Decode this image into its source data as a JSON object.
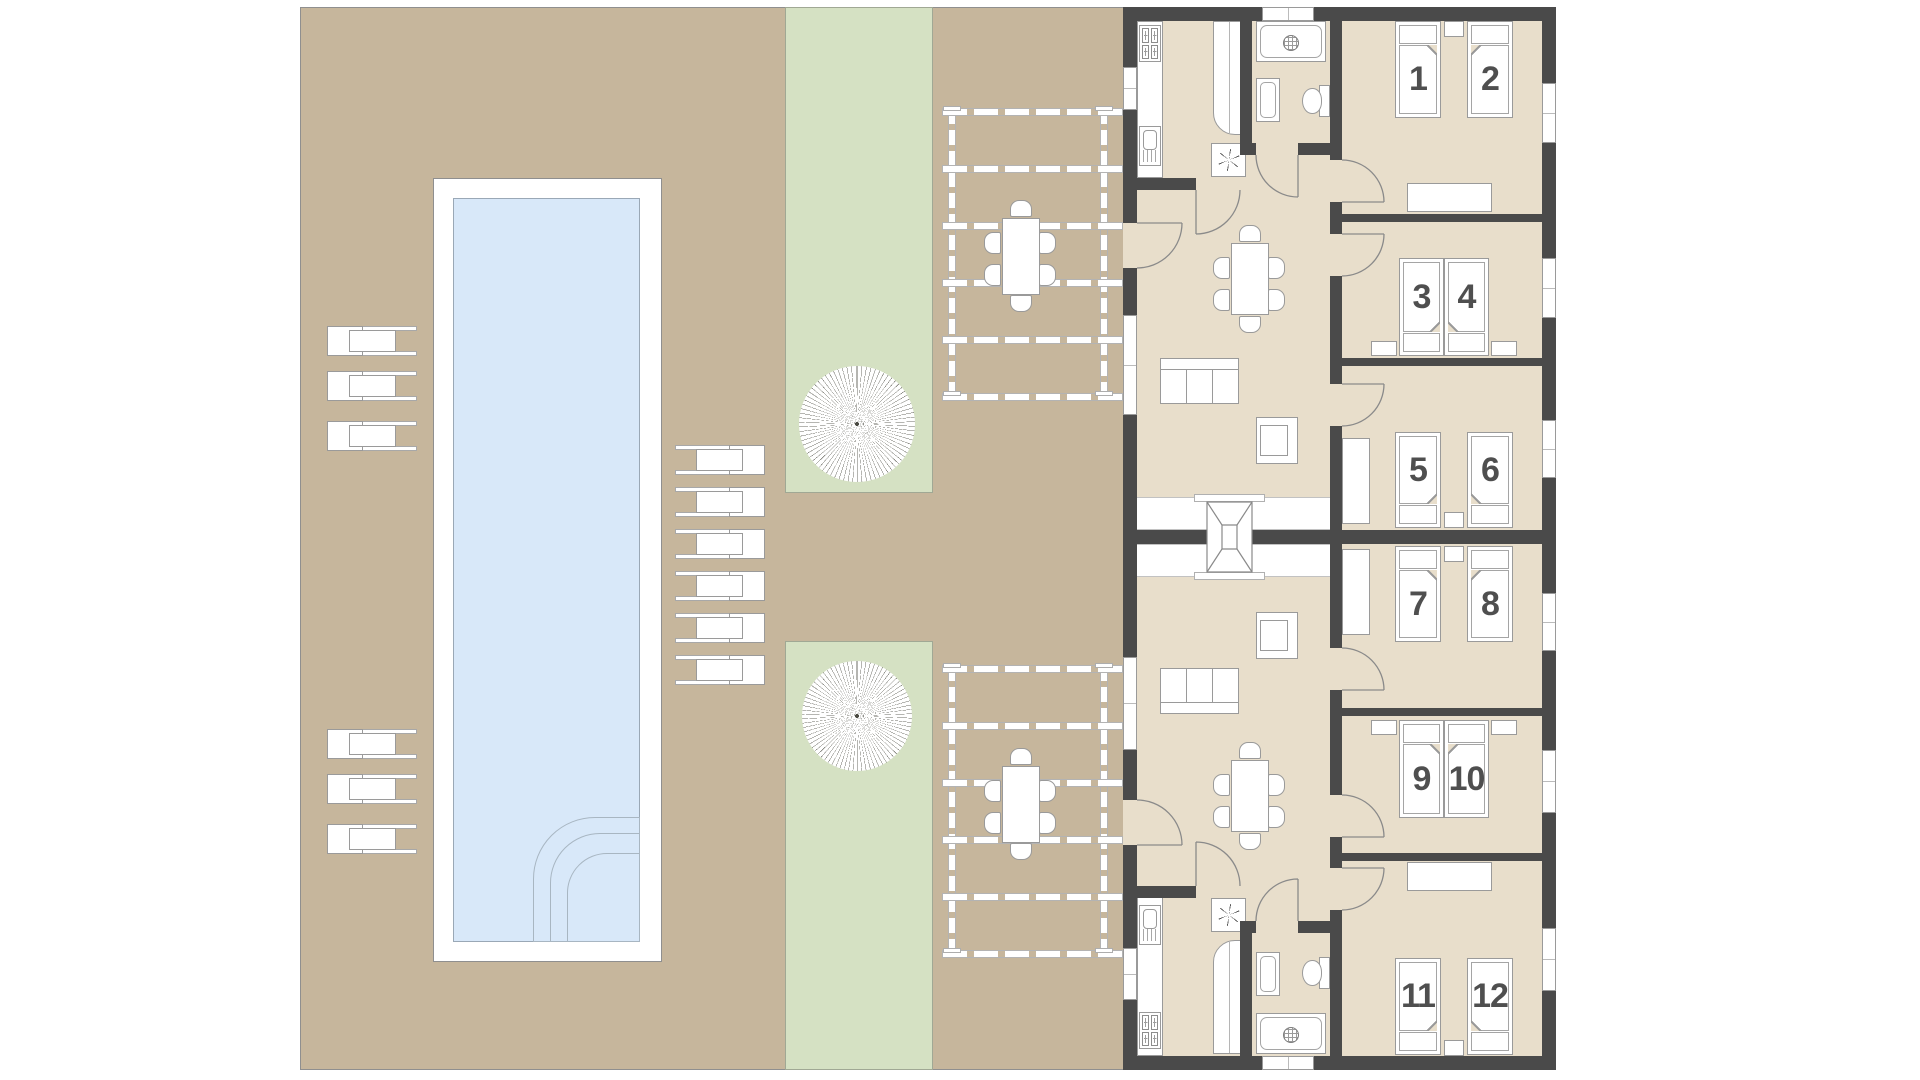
{
  "plan": {
    "title": "Twin holiday apartments with pool — floor plan",
    "visible_text": [
      "1",
      "2",
      "3",
      "4",
      "5",
      "6",
      "7",
      "8",
      "9",
      "10",
      "11",
      "12"
    ]
  },
  "colors": {
    "background": "#ffffff",
    "patio": "#c6b69c",
    "grass": "#d5e1c3",
    "pool_water": "#d8e8f9",
    "pool_deck": "#ffffff",
    "building_floor": "#e8decb",
    "wall": "#4a4a4a",
    "furniture_outline": "#9a9a9a",
    "bed_number": "#4f4f4f"
  },
  "site": {
    "pool": {
      "name": "swimming-pool",
      "corner_steps": 3
    },
    "loungers_left": 6,
    "loungers_right": 6,
    "trees": 2,
    "pergolas": 2,
    "outdoor_dining_seats_per_pergola": 6
  },
  "icons": {
    "extractor": "six-spoke-asterisk",
    "drain": "hatched-circle",
    "skylight": "x-braced-rooflight",
    "stove": "four-burner-hob"
  },
  "building": {
    "units": [
      {
        "id": "unit-a",
        "rooms": [
          "kitchen",
          "bathroom",
          "living-dining"
        ],
        "bedrooms": [
          {
            "beds": [
              {
                "number": "1"
              },
              {
                "number": "2"
              }
            ]
          },
          {
            "beds": [
              {
                "number": "3"
              },
              {
                "number": "4"
              }
            ]
          },
          {
            "beds": [
              {
                "number": "5"
              },
              {
                "number": "6"
              }
            ]
          }
        ]
      },
      {
        "id": "unit-b",
        "rooms": [
          "kitchen",
          "bathroom",
          "living-dining"
        ],
        "bedrooms": [
          {
            "beds": [
              {
                "number": "7"
              },
              {
                "number": "8"
              }
            ]
          },
          {
            "beds": [
              {
                "number": "9"
              },
              {
                "number": "10"
              }
            ]
          },
          {
            "beds": [
              {
                "number": "11"
              },
              {
                "number": "12"
              }
            ]
          }
        ]
      }
    ]
  }
}
